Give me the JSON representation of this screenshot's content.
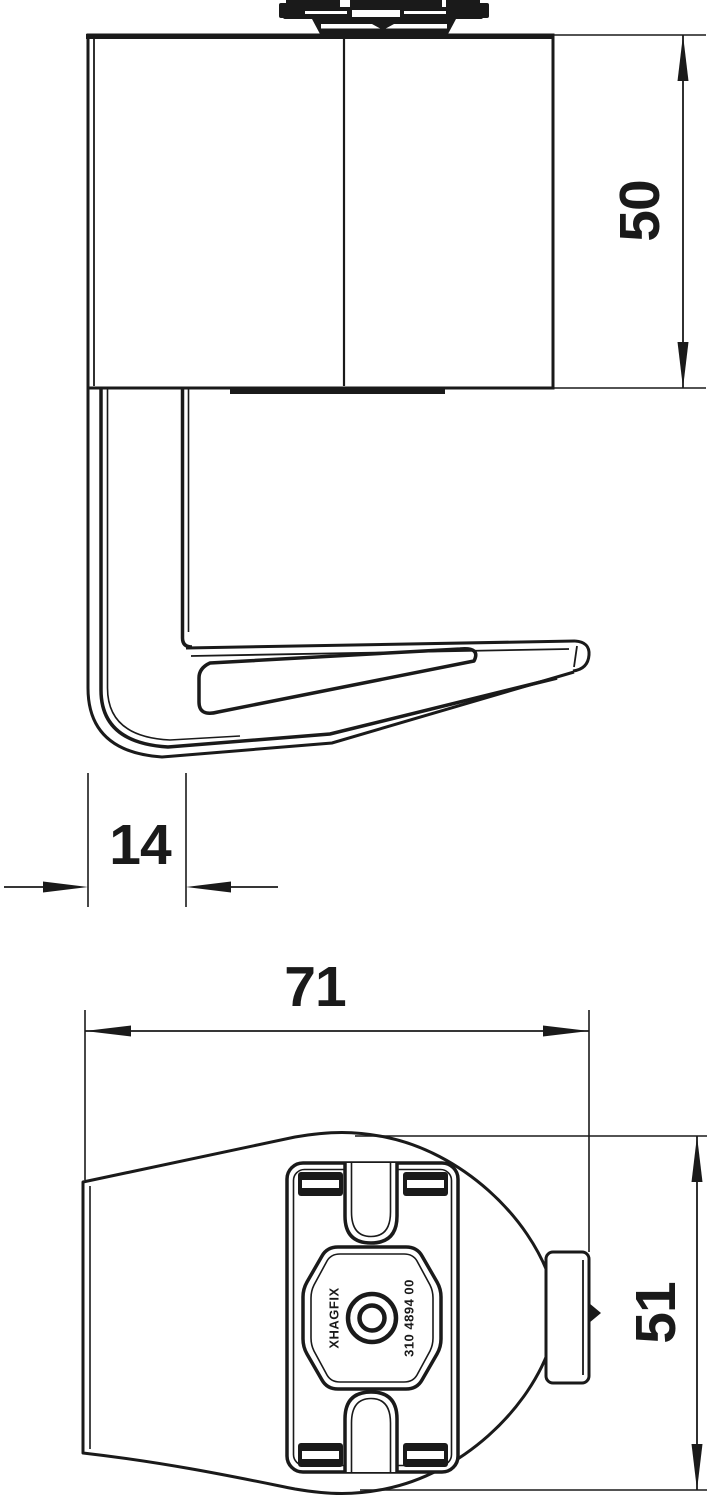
{
  "dimensions": {
    "d50": "50",
    "d14": "14",
    "d71": "71",
    "d51": "51"
  },
  "markings": {
    "left": "XHAGFIX",
    "right": "310 4894 00"
  },
  "colors": {
    "ink": "#1a1a1a",
    "paper": "#ffffff"
  }
}
